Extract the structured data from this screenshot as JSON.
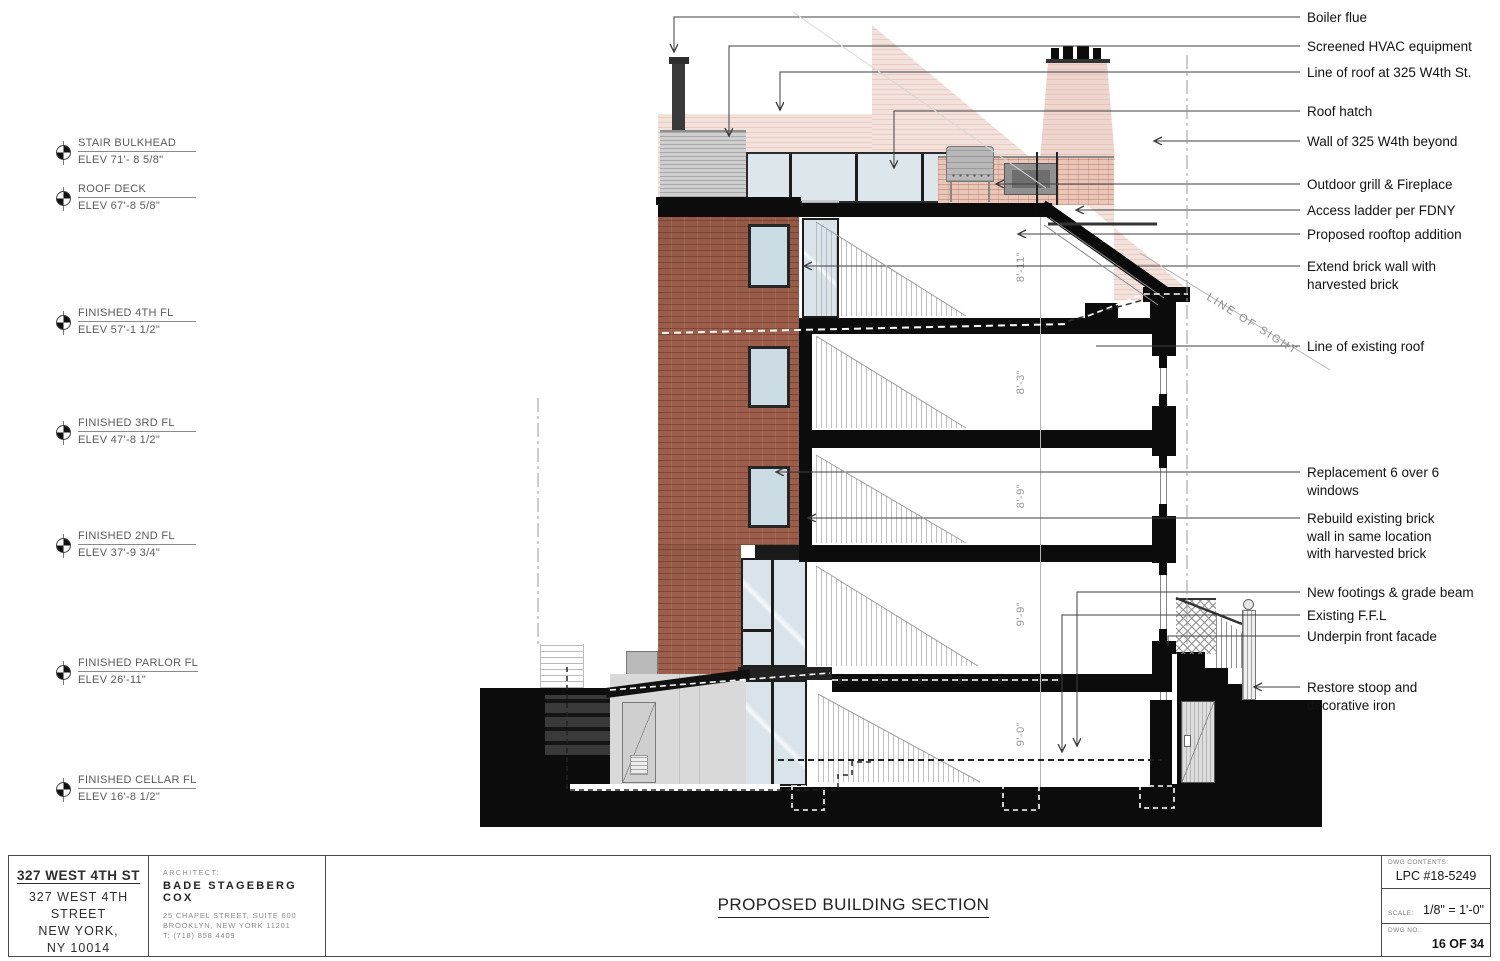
{
  "drawing": {
    "line_of_sight": "LINE OF SIGHT",
    "dimensions": [
      "8'-11\"",
      "8'-3\"",
      "8'-9\"",
      "9'-9\"",
      "9'-0\""
    ]
  },
  "elevation_markers": [
    {
      "name": "STAIR BULKHEAD",
      "elev": "ELEV 71'- 8 5/8\""
    },
    {
      "name": "ROOF DECK",
      "elev": "ELEV 67'-8 5/8\""
    },
    {
      "name": "FINISHED 4TH FL",
      "elev": "ELEV 57'-1 1/2\""
    },
    {
      "name": "FINISHED 3RD FL",
      "elev": "ELEV 47'-8 1/2\""
    },
    {
      "name": "FINISHED 2ND FL",
      "elev": "ELEV 37'-9 3/4\""
    },
    {
      "name": "FINISHED PARLOR FL",
      "elev": "ELEV 26'-11\""
    },
    {
      "name": "FINISHED CELLAR FL",
      "elev": "ELEV 16'-8 1/2\""
    }
  ],
  "callouts": [
    "Boiler flue",
    "Screened HVAC equipment",
    "Line of roof at 325 W4th St.",
    "Roof hatch",
    "Wall of 325 W4th beyond",
    "Outdoor grill & Fireplace",
    "Access ladder per FDNY",
    "Proposed rooftop addition",
    "Extend brick wall with\nharvested brick",
    "Line of existing roof",
    "Replacement 6 over 6\nwindows",
    "Rebuild existing brick\nwall in same location\nwith harvested brick",
    "New footings & grade beam",
    "Existing F.F.L",
    "Underpin front facade",
    "Restore stoop and\ndecorative iron"
  ],
  "titleblock": {
    "project_name": "327 WEST 4TH ST",
    "project_address": "327 WEST 4TH\nSTREET\nNEW YORK,\nNY 10014",
    "architect_label": "ARCHITECT:",
    "architect_name": "BADE STAGEBERG COX",
    "architect_address1": "25 CHAPEL STREET, SUITE 600",
    "architect_address2": "BROOKLYN, NEW YORK 11201",
    "architect_phone": "T: (718) 858 4409",
    "sheet_title": "PROPOSED BUILDING SECTION",
    "dwg_contents_label": "DWG CONTENTS:",
    "dwg_contents": "LPC #18-5249",
    "scale_label": "SCALE:",
    "scale": "1/8\" = 1'-0\"",
    "dwg_no_label": "DWG NO.:",
    "dwg_no": "16 OF 34"
  }
}
